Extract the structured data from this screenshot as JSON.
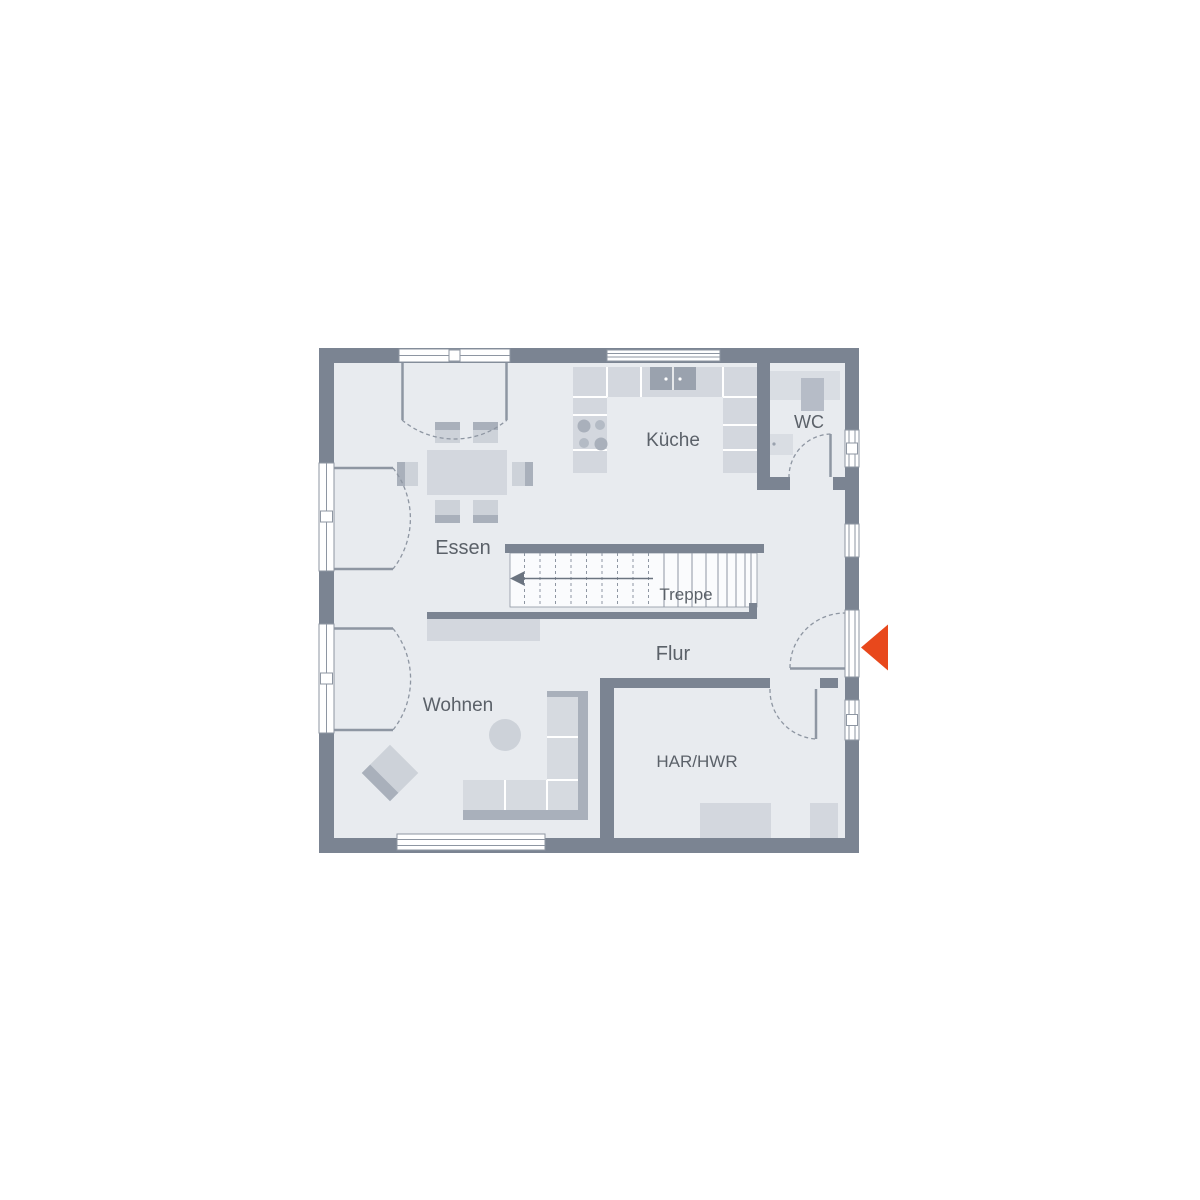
{
  "rooms": {
    "essen": "Essen",
    "kueche": "Küche",
    "wc": "WC",
    "treppe": "Treppe",
    "flur": "Flur",
    "wohnen": "Wohnen",
    "har_hwr": "HAR/HWR"
  },
  "icons": {
    "entrance_arrow": "◀"
  },
  "colors": {
    "background": "#ffffff",
    "wall": "#7b8492",
    "floor": "#e8ebef",
    "stair": "#fafbfd",
    "counter": "#d3d7de",
    "furniture_light": "#d6dae0",
    "furniture_mid": "#cdd2d9",
    "furniture_dark": "#a9b0bb",
    "appliance_dark": "#9aa2ae",
    "fixture": "#d9dde3",
    "toilet": "#b6bcc7",
    "burner_light": "#b4bbc5",
    "outline": "#8e96a2",
    "walkline": "#6b7480",
    "label": "#5b6169",
    "entrance_accent": "#e8481c"
  }
}
